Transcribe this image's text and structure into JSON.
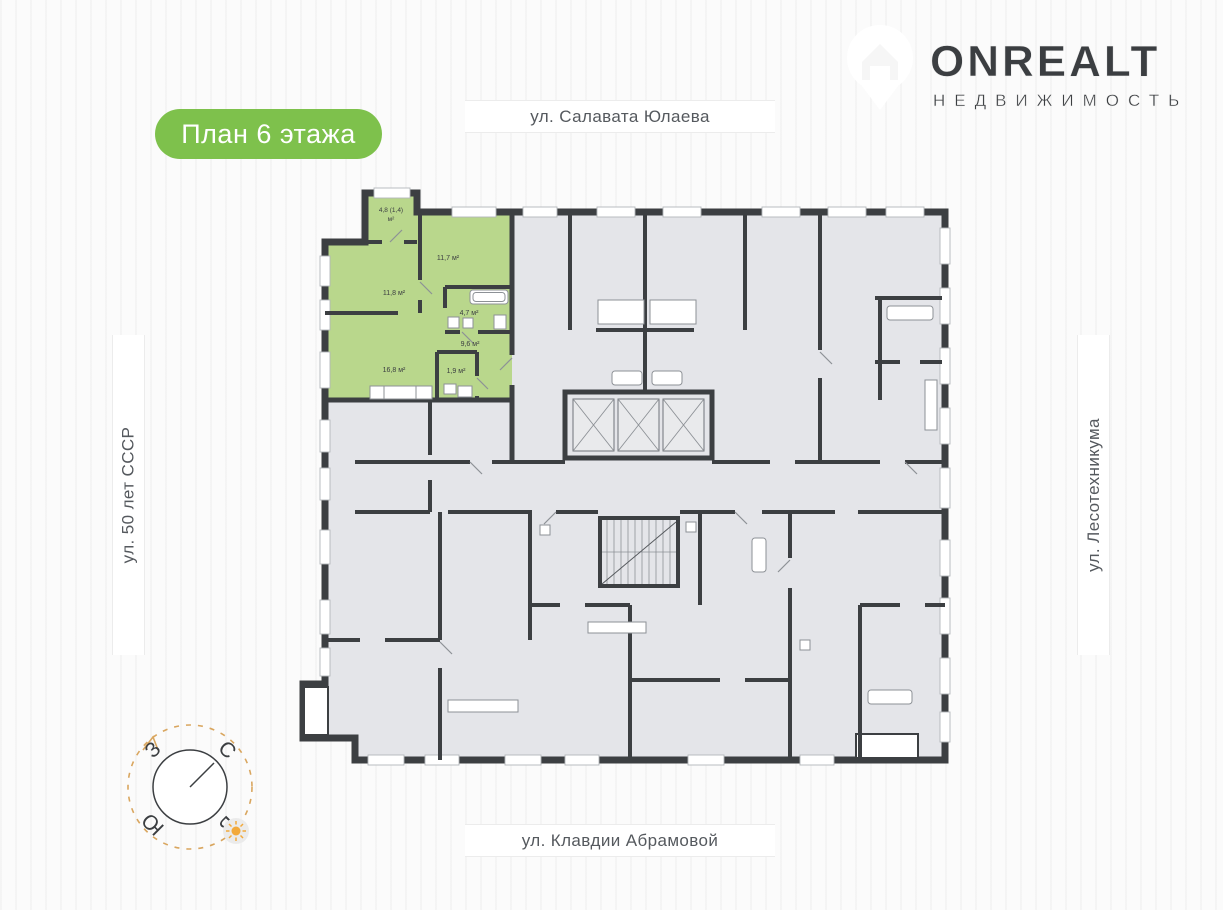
{
  "header": {
    "floor_badge_label": "План 6 этажа",
    "logo_brand": "ONREALT",
    "logo_subtitle": "НЕДВИЖИМОСТЬ"
  },
  "streets": {
    "top": "ул. Салавата Юлаева",
    "bottom": "ул. Клавдии Абрамовой",
    "left": "ул. 50 лет СССР",
    "right": "ул. Лесотехникума"
  },
  "compass": {
    "north": "С",
    "south": "Ю",
    "west": "З",
    "east": "В"
  },
  "plan": {
    "rooms": {
      "balcony_line1": "4,8 (1,4)",
      "balcony_line2": "м²",
      "room_a": "11,7 м²",
      "room_b": "11,8 м²",
      "bathroom": "4,7 м²",
      "hallway": "9,6 м²",
      "kitchen_living": "16,8 м²",
      "wc": "1,9 м²"
    },
    "colors": {
      "highlight": "#b9d78c",
      "walls": "#3c3f42",
      "rooms_fill": "#e4e5e9",
      "badge_green": "#7ec14c",
      "compass_ring": "#d9a65f",
      "sun": "#f2a93b",
      "street_text": "#55595e"
    }
  }
}
